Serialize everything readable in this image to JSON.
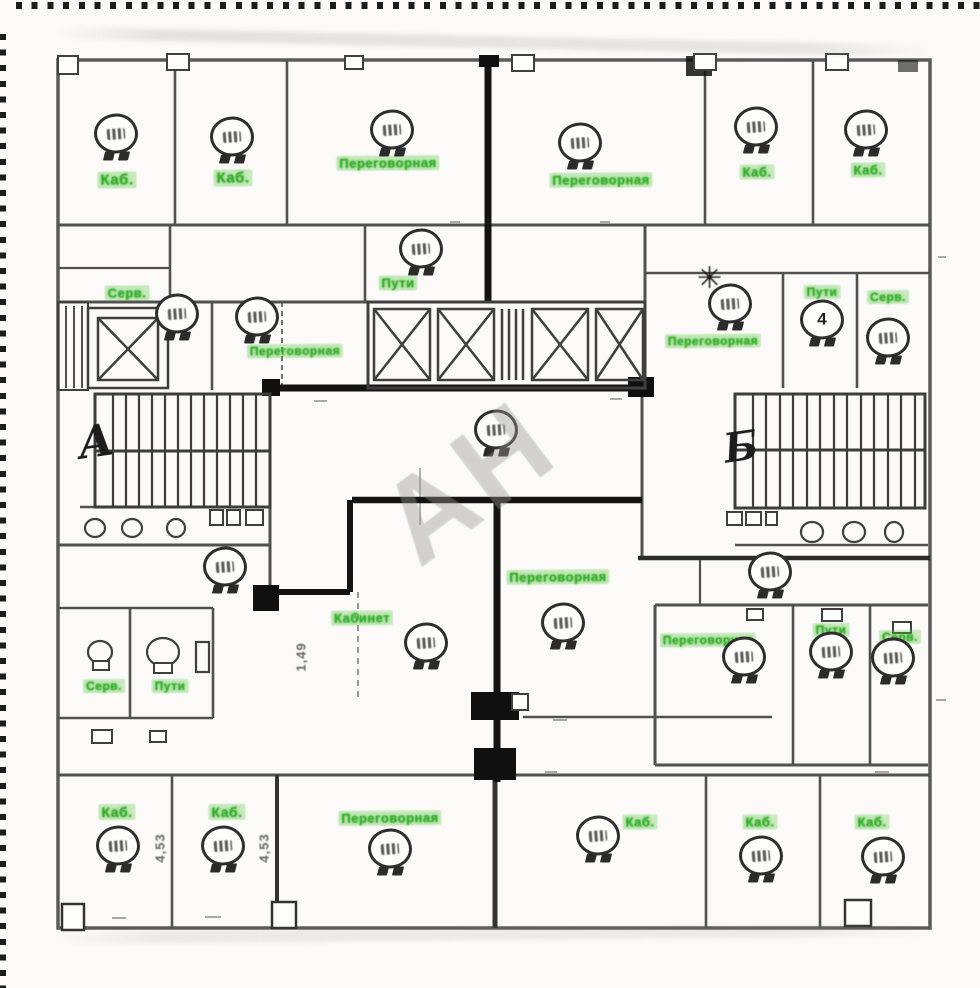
{
  "plan": {
    "watermark": "АН",
    "stair_markers": {
      "left": "А",
      "right": "Б"
    },
    "colors": {
      "label_green": "#3aa435",
      "heavy_wall": "#141414",
      "wall": "#4f4f4f",
      "paper": "#fbfaf8"
    },
    "room_labels": [
      {
        "text": "Каб.",
        "x": 117,
        "y": 180,
        "size": 15
      },
      {
        "text": "Каб.",
        "x": 233,
        "y": 178,
        "size": 15
      },
      {
        "text": "Переговорная",
        "x": 388,
        "y": 163,
        "size": 13
      },
      {
        "text": "Переговорная",
        "x": 601,
        "y": 180,
        "size": 13
      },
      {
        "text": "Каб.",
        "x": 757,
        "y": 172,
        "size": 13
      },
      {
        "text": "Каб.",
        "x": 868,
        "y": 170,
        "size": 13
      },
      {
        "text": "Серв.",
        "x": 127,
        "y": 293,
        "size": 13
      },
      {
        "text": "Пути",
        "x": 398,
        "y": 283,
        "size": 13
      },
      {
        "text": "Переговорная",
        "x": 295,
        "y": 351,
        "size": 12
      },
      {
        "text": "Переговорная",
        "x": 713,
        "y": 341,
        "size": 12
      },
      {
        "text": "Пути",
        "x": 822,
        "y": 292,
        "size": 12
      },
      {
        "text": "Серв.",
        "x": 888,
        "y": 297,
        "size": 12
      },
      {
        "text": "Переговорная",
        "x": 558,
        "y": 577,
        "size": 13
      },
      {
        "text": "Кабинет",
        "x": 362,
        "y": 618,
        "size": 13
      },
      {
        "text": "Серв.",
        "x": 104,
        "y": 686,
        "size": 12
      },
      {
        "text": "Пути",
        "x": 170,
        "y": 686,
        "size": 12
      },
      {
        "text": "Переговорная",
        "x": 708,
        "y": 640,
        "size": 12
      },
      {
        "text": "Пути",
        "x": 831,
        "y": 630,
        "size": 12
      },
      {
        "text": "Серв.",
        "x": 900,
        "y": 637,
        "size": 12
      },
      {
        "text": "Каб.",
        "x": 117,
        "y": 812,
        "size": 14
      },
      {
        "text": "Каб.",
        "x": 227,
        "y": 812,
        "size": 14
      },
      {
        "text": "Переговорная",
        "x": 390,
        "y": 818,
        "size": 13
      },
      {
        "text": "Каб.",
        "x": 640,
        "y": 822,
        "size": 13
      },
      {
        "text": "Каб.",
        "x": 760,
        "y": 822,
        "size": 13
      },
      {
        "text": "Каб.",
        "x": 872,
        "y": 822,
        "size": 13
      }
    ],
    "balloons": [
      {
        "x": 116,
        "y": 137,
        "value": ""
      },
      {
        "x": 232,
        "y": 140,
        "value": ""
      },
      {
        "x": 392,
        "y": 133,
        "value": ""
      },
      {
        "x": 580,
        "y": 146,
        "value": ""
      },
      {
        "x": 756,
        "y": 130,
        "value": ""
      },
      {
        "x": 866,
        "y": 133,
        "value": ""
      },
      {
        "x": 421,
        "y": 252,
        "value": ""
      },
      {
        "x": 177,
        "y": 317,
        "value": ""
      },
      {
        "x": 257,
        "y": 320,
        "value": ""
      },
      {
        "x": 730,
        "y": 307,
        "value": ""
      },
      {
        "x": 822,
        "y": 323,
        "value": "4"
      },
      {
        "x": 888,
        "y": 341,
        "value": ""
      },
      {
        "x": 496,
        "y": 433,
        "value": ""
      },
      {
        "x": 225,
        "y": 570,
        "value": ""
      },
      {
        "x": 426,
        "y": 646,
        "value": ""
      },
      {
        "x": 563,
        "y": 626,
        "value": ""
      },
      {
        "x": 770,
        "y": 575,
        "value": ""
      },
      {
        "x": 744,
        "y": 660,
        "value": ""
      },
      {
        "x": 831,
        "y": 655,
        "value": ""
      },
      {
        "x": 893,
        "y": 661,
        "value": ""
      },
      {
        "x": 118,
        "y": 849,
        "value": ""
      },
      {
        "x": 223,
        "y": 849,
        "value": ""
      },
      {
        "x": 390,
        "y": 852,
        "value": ""
      },
      {
        "x": 598,
        "y": 839,
        "value": ""
      },
      {
        "x": 761,
        "y": 859,
        "value": ""
      },
      {
        "x": 883,
        "y": 860,
        "value": ""
      }
    ],
    "dimension_texts": [
      {
        "text": "1,49",
        "x": 301,
        "y": 657
      },
      {
        "text": "4,53",
        "x": 160,
        "y": 848
      },
      {
        "text": "4,53",
        "x": 264,
        "y": 848
      }
    ],
    "column_symbol": "✳"
  }
}
